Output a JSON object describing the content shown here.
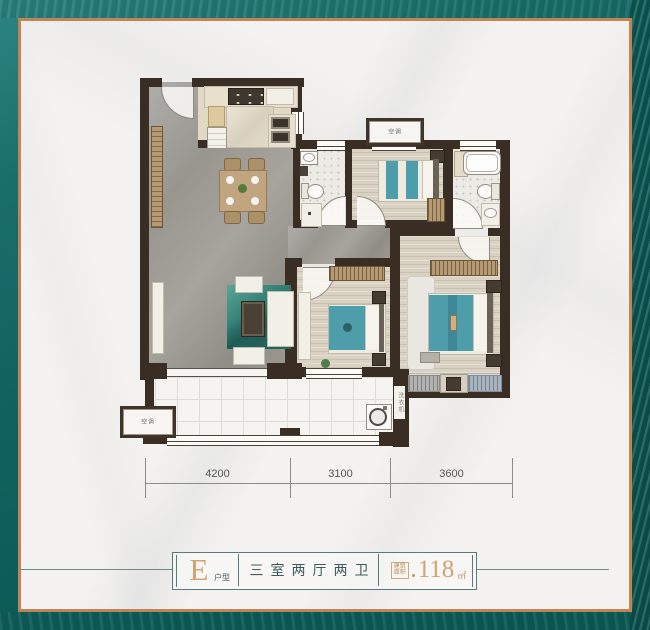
{
  "palette": {
    "frame_teal": "#0f605d",
    "frame_copper": "#c08557",
    "wall_color": "#3a2d23",
    "accent_tan": "#d2a273",
    "legend_text_teal": "#3f5a5e",
    "bed_teal": "#4e9dab"
  },
  "floor_plan": {
    "dimension_ticks": [
      "4200",
      "3100",
      "3600"
    ],
    "ac_platform_label": "空调",
    "washer_label": "洗衣机"
  },
  "legend": {
    "unit_letter": "E",
    "unit_word": "户型",
    "layout_text": "三室两厅两卫",
    "area_word_top": "建筑",
    "area_word_bottom": "面积",
    "area_value": "118",
    "area_unit": "㎡"
  }
}
